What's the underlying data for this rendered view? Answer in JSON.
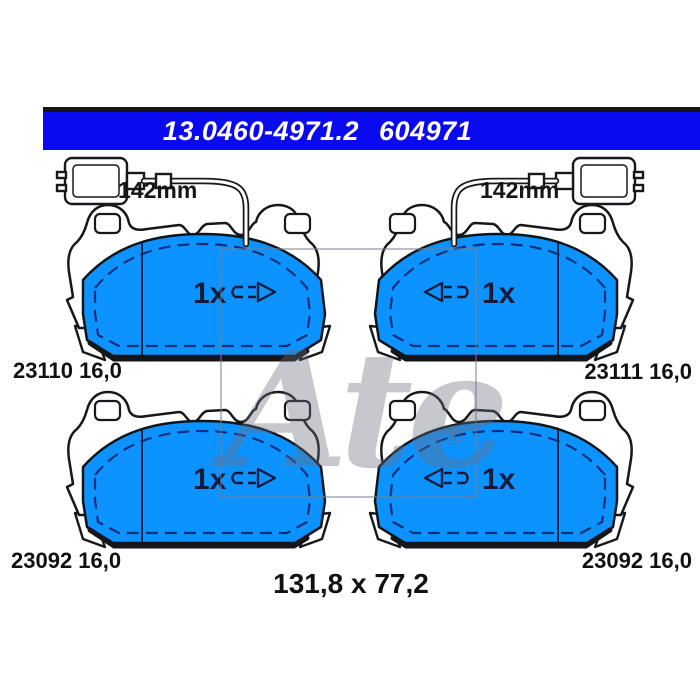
{
  "header": {
    "part_number": "13.0460-4971.2",
    "reference": "604971"
  },
  "pads": {
    "top_left": {
      "label": "23110 16,0",
      "wire_length": "142mm",
      "quantity": "1x"
    },
    "top_right": {
      "label": "23111 16,0",
      "wire_length": "142mm",
      "quantity": "1x"
    },
    "bottom_left": {
      "label": "23092 16,0",
      "quantity": "1x"
    },
    "bottom_right": {
      "label": "23092 16,0",
      "quantity": "1x"
    }
  },
  "footer": {
    "dimensions": "131,8 x 77,2"
  },
  "watermark": {
    "brand": "Ate",
    "registered": "®"
  },
  "colors": {
    "header_blue": "#0a0af0",
    "friction_blue": "#0d93ff",
    "outline_black": "#16181c",
    "dash_navy": "#0c2f7a"
  }
}
